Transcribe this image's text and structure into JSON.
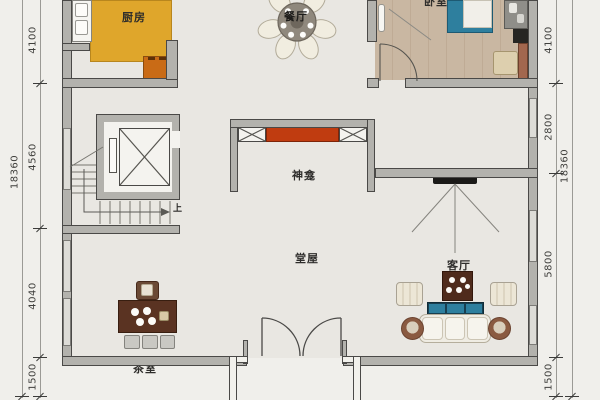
{
  "rooms": {
    "kitchen": "厨房",
    "dining": "餐厅",
    "bedroom": "卧室",
    "shrine": "神龛",
    "main_hall": "堂屋",
    "living": "客厅",
    "tea_room": "茶室"
  },
  "stairs": {
    "up_label": "上"
  },
  "dimensions": {
    "left": {
      "overall": "18360",
      "segments": [
        "4100",
        "4560",
        "4040",
        "1500"
      ]
    },
    "right": {
      "overall": "18360",
      "segments": [
        "4100",
        "2800",
        "5800",
        "1500"
      ]
    }
  },
  "colors": {
    "kitchen_floor": "#dfa62b",
    "stove": "#c96b16",
    "altar_red": "#c03c10",
    "bed_blue": "#2e7f9e",
    "sofa_cushion_blue": "#2e7f9e",
    "bedroom_wood": "#c9b7a2",
    "wall_fill": "#b3b2ad",
    "wall_edge": "#4a4947",
    "table_brown": "#502c1c"
  }
}
